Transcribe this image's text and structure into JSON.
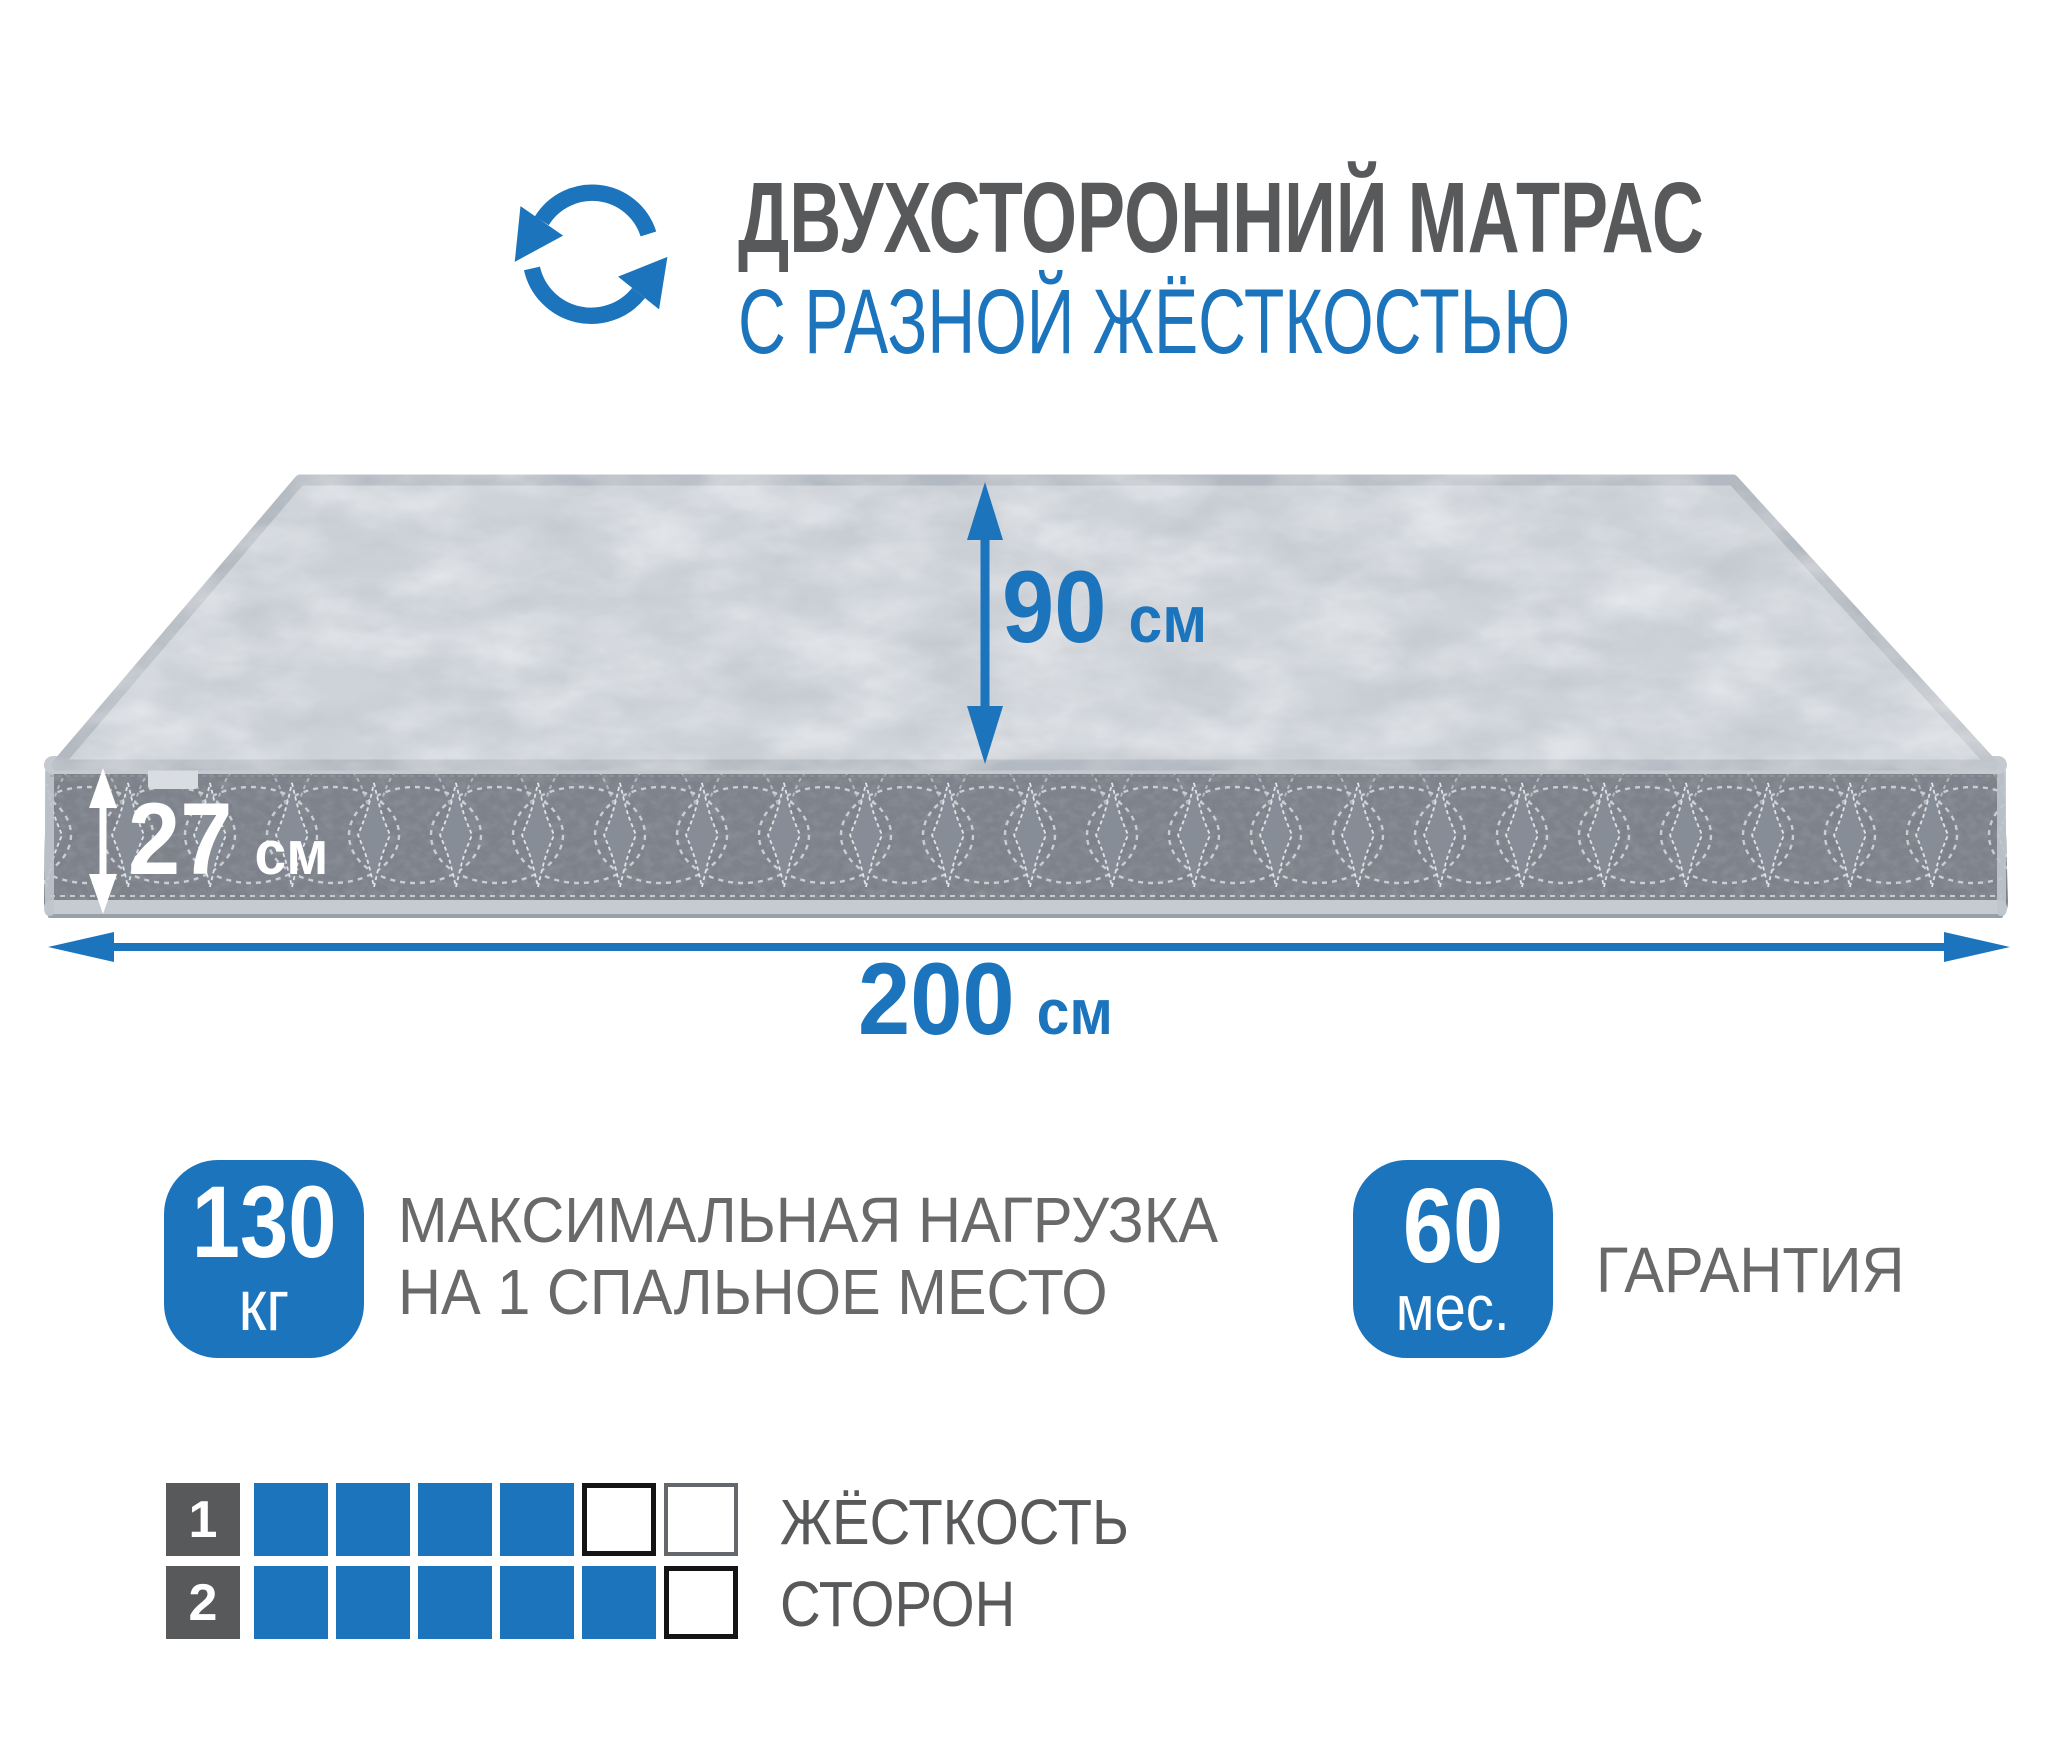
{
  "header": {
    "icon": "rotate-arrows-icon",
    "title": "ДВУХСТОРОННИЙ МАТРАС",
    "subtitle": "С РАЗНОЙ ЖЁСТКОСТЬЮ"
  },
  "dimensions": {
    "width": {
      "value": "90",
      "unit": "см"
    },
    "thickness": {
      "value": "27",
      "unit": "см"
    },
    "length": {
      "value": "200",
      "unit": "см"
    }
  },
  "badges": {
    "max_load": {
      "value": "130",
      "unit": "кг",
      "label_line1": "МАКСИМАЛЬНАЯ НАГРУЗКА",
      "label_line2": "НА 1 СПАЛЬНОЕ МЕСТО"
    },
    "warranty": {
      "value": "60",
      "unit": "мес.",
      "label": "ГАРАНТИЯ"
    }
  },
  "firmness": {
    "label_line1": "ЖЁСТКОСТЬ",
    "label_line2": "СТОРОН",
    "scale_max": 6,
    "rows": [
      {
        "label": "1",
        "filled": 4,
        "cells": [
          "filled",
          "filled",
          "filled",
          "filled",
          "empty-strong",
          "empty-weak"
        ]
      },
      {
        "label": "2",
        "filled": 5,
        "cells": [
          "filled",
          "filled",
          "filled",
          "filled",
          "filled",
          "empty-strong"
        ]
      }
    ]
  },
  "colors": {
    "accent": "#1b74bc",
    "title_gray": "#58595b",
    "text_gray": "#696969",
    "mattress_top": "#ced3d9",
    "mattress_side": "#7e838c"
  }
}
